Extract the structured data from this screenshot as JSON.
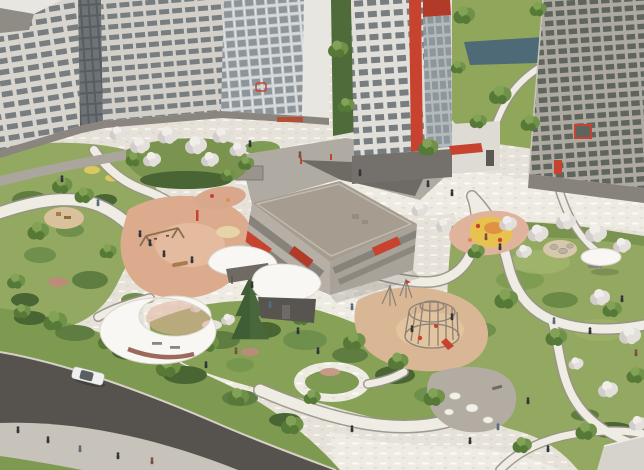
{
  "meta": {
    "title": "Residential courtyard — aerial architectural rendering",
    "type": "architectural-visualization",
    "view": "aerial three-quarter view",
    "visible_text": "none"
  },
  "palette": {
    "paving_base": "#e6e2d9",
    "plaza_bg": "#eeebe3",
    "path_fill": "#efece4",
    "path_edge": "#99938a",
    "lawn": "#93a961",
    "lawn_dark": "#7a9450",
    "shrub": "#5f7d41",
    "shrub_dark": "#4a6534",
    "tree_green": "#6f9148",
    "tree_blossom": "#e3dfdb",
    "conifer": "#3f5e35",
    "asphalt": "#56524d",
    "sidewalk": "#c7c2ba",
    "curb": "#d7d2c9",
    "grass_verge": "#7e9a50",
    "facade_white": "#d8d5cf",
    "facade_gray": "#aeaaa2",
    "window_dark": "#787d7f",
    "glass_dark": "#585d60",
    "accent_red": "#c8432f",
    "garage_roof": "#a69d90",
    "garage_facade": "#b5afa6",
    "pond": "#4d6a76",
    "canopy_white": "#f8f7f3",
    "canopy_wall": "#9b6a5c",
    "play_salmon": "#dcab8e",
    "play_tan": "#d9b694",
    "play_pink": "#e0b39c",
    "play_yellow": "#e7c24f",
    "play_orange": "#df9242",
    "plaza_gray": "#b2aca3",
    "person": "#34353a",
    "car_body": "#eff1f0"
  },
  "scene": {
    "buildings": [
      {
        "name": "left-apartment-complex",
        "style": "white multi-storey slabs, dark glass stair stripe, glass balcony wing",
        "accent": "small red logo square"
      },
      {
        "name": "central-tower",
        "style": "white high-rise with red vertical stripe and red crown, glass balcony column"
      },
      {
        "name": "right-apartment-building",
        "style": "gray grid facade, red framed window, red entrance door"
      },
      {
        "name": "parking-garage",
        "style": "low flat-roof volume, banded facade with red accent panels"
      },
      {
        "name": "corner-building-bottom-right",
        "style": "light flat roof edge"
      }
    ],
    "landscape": [
      "pond",
      "lawns",
      "shrub beds",
      "blossoming white trees",
      "green trees",
      "single conifer",
      "flower patches"
    ],
    "features": [
      "winding-light-paths",
      "central-plaza",
      "playground-left-salmon",
      "playground-climbing-dome",
      "playground-orange-mound",
      "small-hill-playground",
      "small-upper-playground",
      "crescent-shade-canopy",
      "small-shade-canopy",
      "white-roof-pavilion",
      "umbrella-canopy",
      "boulder-plaza",
      "lawn-island",
      "road",
      "sidewalk",
      "white-car",
      "pedestrians"
    ],
    "counts": {
      "pedestrians": 36,
      "cars": 1,
      "shade_canopies": 3,
      "pavilions": 1,
      "playgrounds": 5,
      "ponds": 1,
      "trees_green": 36,
      "trees_blossom": 23,
      "conifers": 1
    }
  }
}
